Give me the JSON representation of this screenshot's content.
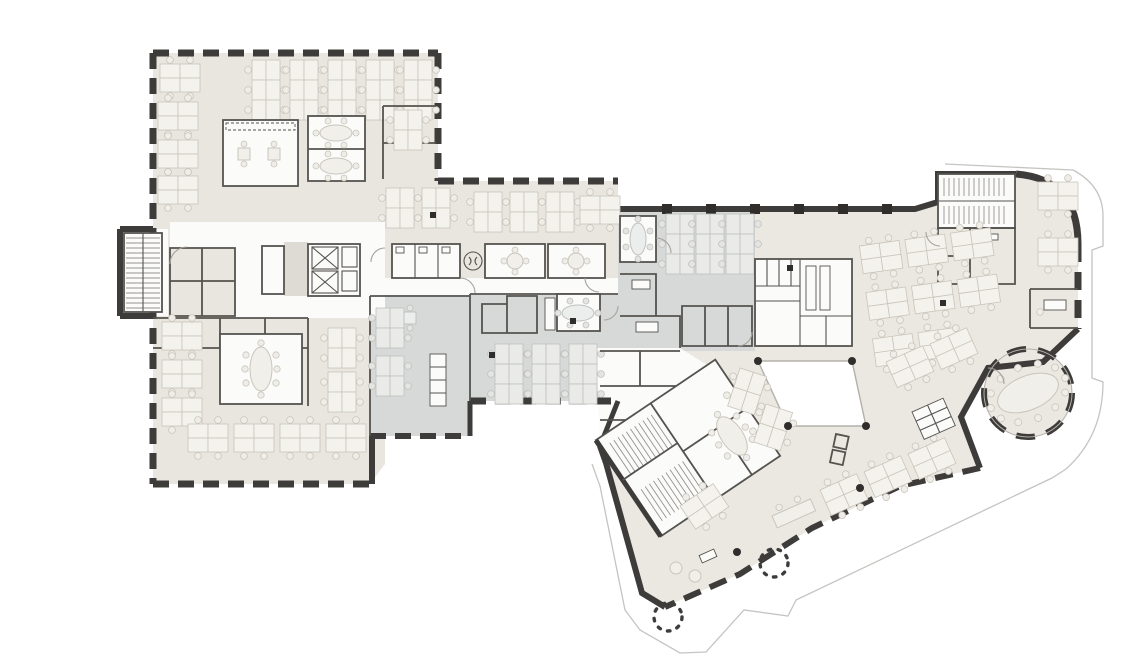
{
  "meta": {
    "title": "Architectural office floor plan",
    "description": "Monochrome office floor plan: north-west rectangular wing and angled south-east wing, beige and grey floor zones, open-plan desk clusters, meeting rooms, stair and lift cores, WC cores, a white atrium void, a circular meeting pavilion and two outdoor trees",
    "orientation": "landscape"
  },
  "colors": {
    "bg": "#ffffff",
    "floor_beige": "#e9e6df",
    "floor_beige_light": "#ebe8e1",
    "floor_gray": "#d7d8d8",
    "corridor": "#fbfbfa",
    "lobby": "#dedbd4",
    "wall": "#3d3c3a",
    "wall_mid": "#55534f",
    "line_light": "#b3b0aa",
    "desk": "#f4f2ec",
    "desk_line": "#c9c5bc",
    "chair": "#efede7",
    "table": "#f1efe9",
    "site": "#c6c4c1",
    "dot": "#2f2e2c",
    "atrium": "#ffffff"
  },
  "legend": {
    "areas": [
      {
        "name": "open-office-beige",
        "color": "#e9e6df"
      },
      {
        "name": "open-office-gray",
        "color": "#d7d8d8"
      },
      {
        "name": "circulation-corridor",
        "color": "#fbfbfa"
      },
      {
        "name": "atrium-void",
        "color": "#ffffff"
      },
      {
        "name": "structure-walls",
        "color": "#3d3c3a"
      }
    ]
  },
  "features": {
    "stair_cores": 3,
    "elevator_shafts": 2,
    "wc_cores": 3,
    "meeting_rooms": 9,
    "desk_clusters": 44,
    "circular_meeting_pavilion": 1,
    "atrium_void": 1,
    "outdoor_trees": 2,
    "structural_columns": 11
  },
  "icons": [
    {
      "name": "stair-treads-icon"
    },
    {
      "name": "elevator-x-icon"
    },
    {
      "name": "tree-icon"
    },
    {
      "name": "column-dot-icon"
    },
    {
      "name": "meeting-table-icon"
    },
    {
      "name": "desk-cluster-icon"
    }
  ]
}
